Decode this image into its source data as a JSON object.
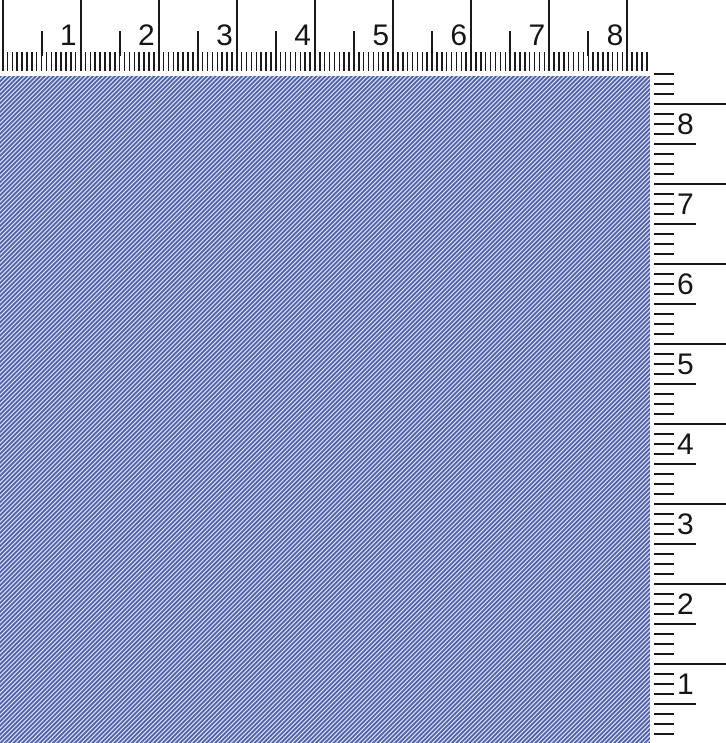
{
  "horizontal_ruler": {
    "side": "top",
    "labels": [
      "1",
      "2",
      "3",
      "4",
      "5",
      "6",
      "7",
      "8"
    ]
  },
  "vertical_ruler": {
    "side": "right",
    "labels": [
      "8",
      "7",
      "6",
      "5",
      "4",
      "3",
      "2",
      "1"
    ]
  },
  "fabric": {
    "pattern": "diagonal-stripe-twill",
    "stripe_direction": "bottom-left-to-top-right"
  },
  "colors": {
    "fabric_stripe": "#5061ab",
    "fabric_light": "#e8eaf4",
    "ruler_background": "#ffffff",
    "tick": "#1a1a1a",
    "label": "#161616"
  }
}
